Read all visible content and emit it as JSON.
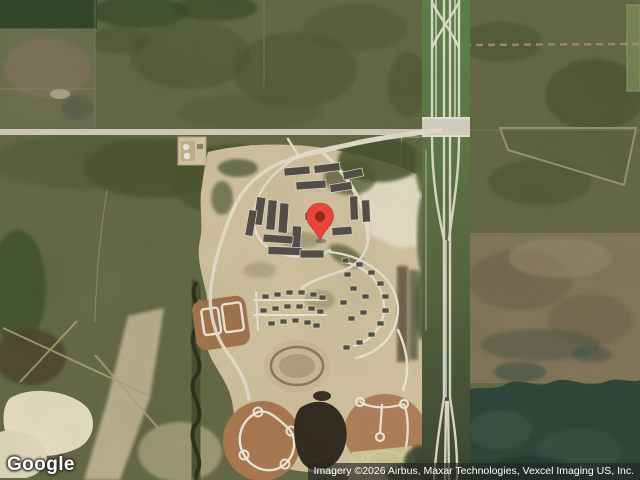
{
  "map": {
    "view_type": "satellite",
    "provider": "Google",
    "attribution_text": "Imagery ©2026 Airbus, Maxar Technologies, Vexcel Imaging US, Inc.",
    "marker": {
      "name": "location-pin",
      "fill": "#E8453A",
      "dot": "#96261A"
    },
    "palette": {
      "field_olive": "#666B47",
      "forest_dark": "#36482B",
      "forest_teal": "#31473B",
      "development_tan": "#D4C5A1",
      "bare_ground": "#E7DEC5",
      "dirt_pad_brown": "#A97A52",
      "road_light": "#E6E0CE",
      "highway_green": "#5E8149",
      "highway_pavement": "#DED9C8",
      "pond_cream": "#EAE2C2",
      "pond_dark": "#342D21"
    }
  }
}
